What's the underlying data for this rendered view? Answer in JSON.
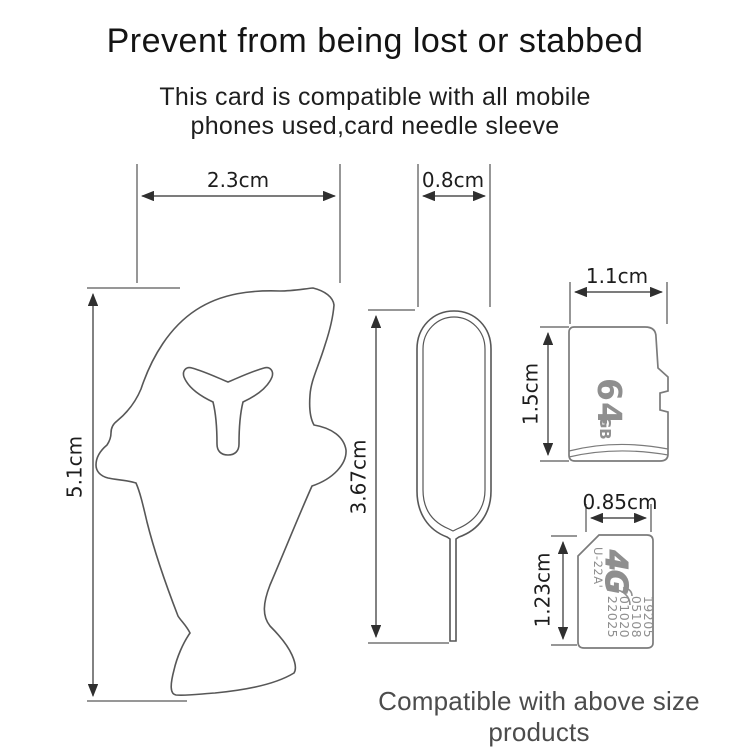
{
  "page": {
    "title": "Prevent from being lost or stabbed",
    "subtitle_line1": "This card is compatible with all mobile",
    "subtitle_line2": "phones used,card needle sleeve",
    "footer_note": "Compatible with above size products"
  },
  "dimensions": {
    "sleeve_width": "2.3cm",
    "sleeve_height": "5.1cm",
    "pin_width": "0.8cm",
    "pin_height": "3.67cm",
    "sd_width": "1.1cm",
    "sd_height": "1.5cm",
    "sim_width": "0.85cm",
    "sim_height": "1.23cm"
  },
  "sd_card": {
    "capacity": "64",
    "unit": "GB"
  },
  "sim_card": {
    "network": "4G",
    "model": "U-22A'",
    "serial_lines": [
      "19205",
      "05108",
      "01020",
      "22025"
    ]
  },
  "colors": {
    "background": "#ffffff",
    "heading_text": "#141414",
    "footer_text": "#4c4c4c",
    "dimension_lines": "#2f2f2f",
    "outline_stroke": "#575757",
    "card_stroke": "#7b7b7b",
    "card_print_text": "#8f8f8f"
  }
}
